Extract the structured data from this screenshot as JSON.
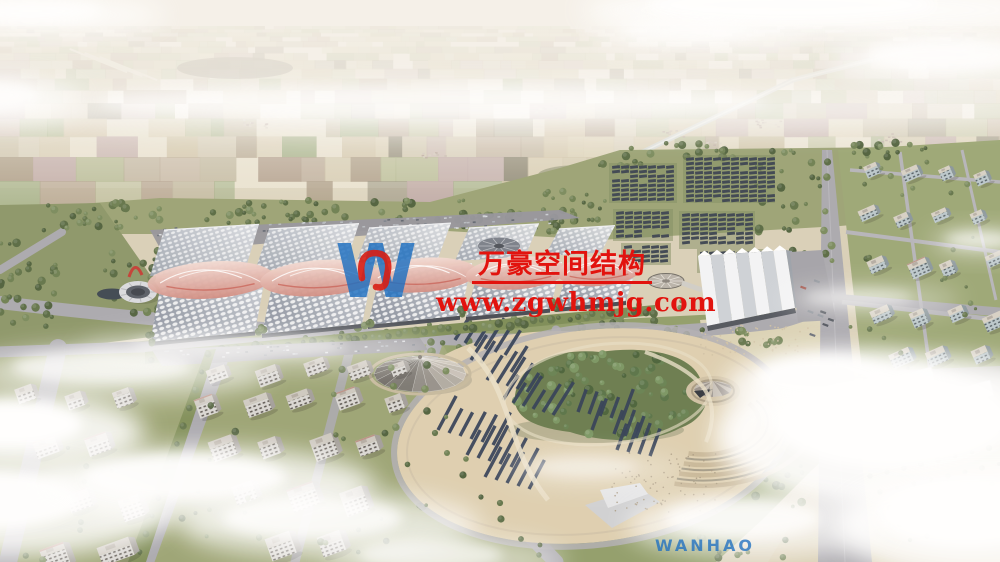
{
  "watermark": {
    "logo_letter": "W",
    "logo_text": "WANHAO",
    "company_name": "万豪空间结构",
    "website": "www.zgwhmjg.com",
    "text_color": "#e2130e",
    "logo_color": "#1f70c1",
    "logo_mark_color": "#d81e14"
  },
  "scene": {
    "palette": {
      "sky_haze": "#f5f1e9",
      "farmland_tan": "#c8b997",
      "farmland_green": "#9fa877",
      "farmland_brown": "#a08a74",
      "farmland_mauve": "#b39a98",
      "vegetation": "#5f7146",
      "road": "#a8a7ad",
      "plaza": "#ddceae",
      "hall_roof_light": "#d3d7dd",
      "hall_roof_shadow": "#7f8694",
      "canopy_pink": "#e8bcb2",
      "canopy_deep": "#d0897e",
      "solar_panel": "#39414d",
      "water": "#3a434d",
      "building_face": "#d8d6d2",
      "building_glass": "#b9c6ca",
      "cloud": "#ffffff"
    }
  }
}
